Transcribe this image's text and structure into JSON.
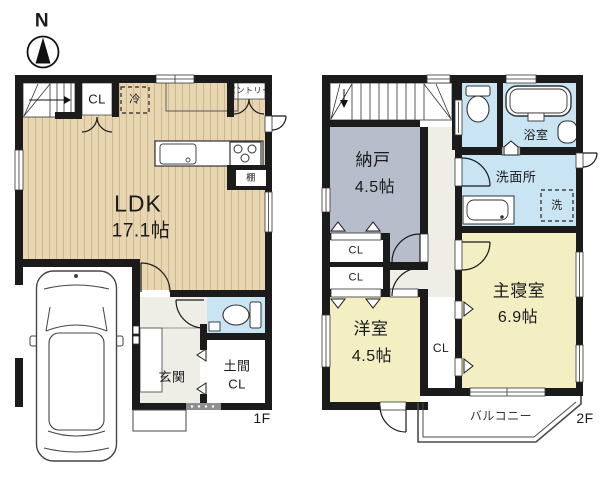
{
  "compass": {
    "north": "N"
  },
  "floor1": {
    "label": "1F",
    "ldk_name": "LDK",
    "ldk_size": "17.1帖",
    "closet": "CL",
    "refrigerator": "冷",
    "pantry": "パントリー",
    "shelf": "棚",
    "entrance": "玄関",
    "doma_closet_line1": "土間",
    "doma_closet_line2": "CL"
  },
  "floor2": {
    "label": "2F",
    "storage_name": "納戸",
    "storage_size": "4.5帖",
    "closet_upper": "CL",
    "closet_lower": "CL",
    "hall_closet": "CL",
    "western_room_name": "洋室",
    "western_room_size": "4.5帖",
    "master_bedroom_name": "主寝室",
    "master_bedroom_size": "6.9帖",
    "bathroom": "浴室",
    "washroom": "洗面所",
    "laundry": "洗",
    "balcony": "バルコニー"
  },
  "colors": {
    "walls": "#1b1b1b",
    "wood_floor": "#e8d6b2",
    "wood_stripe": "#cdb88e",
    "water_rooms": "#c9e4f2",
    "storage_room": "#b7bdca",
    "bedrooms": "#f3efc3",
    "hallway": "#eeede6",
    "background": "#ffffff"
  }
}
